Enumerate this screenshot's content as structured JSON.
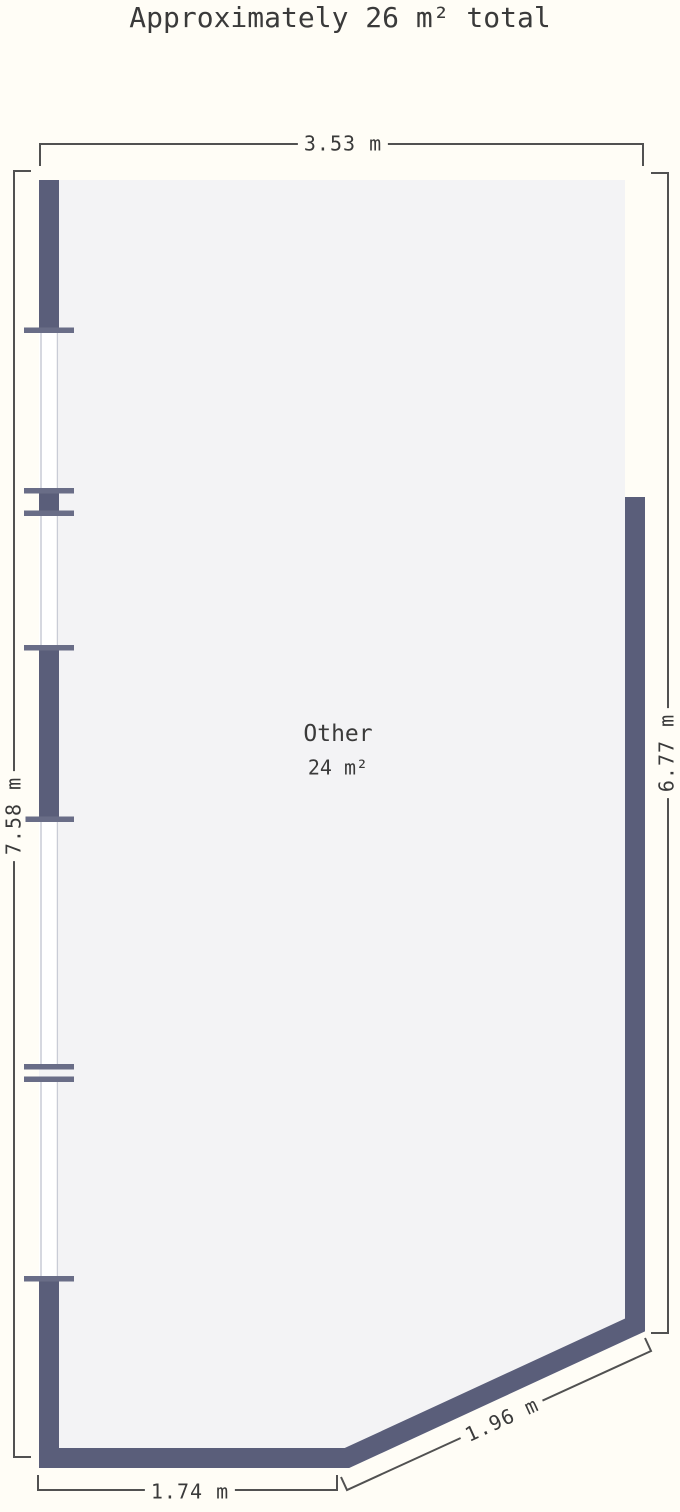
{
  "title": "Approximately 26 m² total",
  "room": {
    "name": "Other",
    "area": "24 m²"
  },
  "dimensions": {
    "top": "3.53 m",
    "left": "7.58 m",
    "right": "6.77 m",
    "bottom": "1.74 m",
    "diagonal": "1.96 m"
  },
  "colors": {
    "background": "#fffdf6",
    "room_fill": "#f3f3f5",
    "wall": "#5a5e7a",
    "wall_cap": "#696d87",
    "window_frame": "#c9ccd6",
    "window_fill": "#ffffff",
    "dimension_line": "#515151",
    "text": "#3a3a3a"
  }
}
